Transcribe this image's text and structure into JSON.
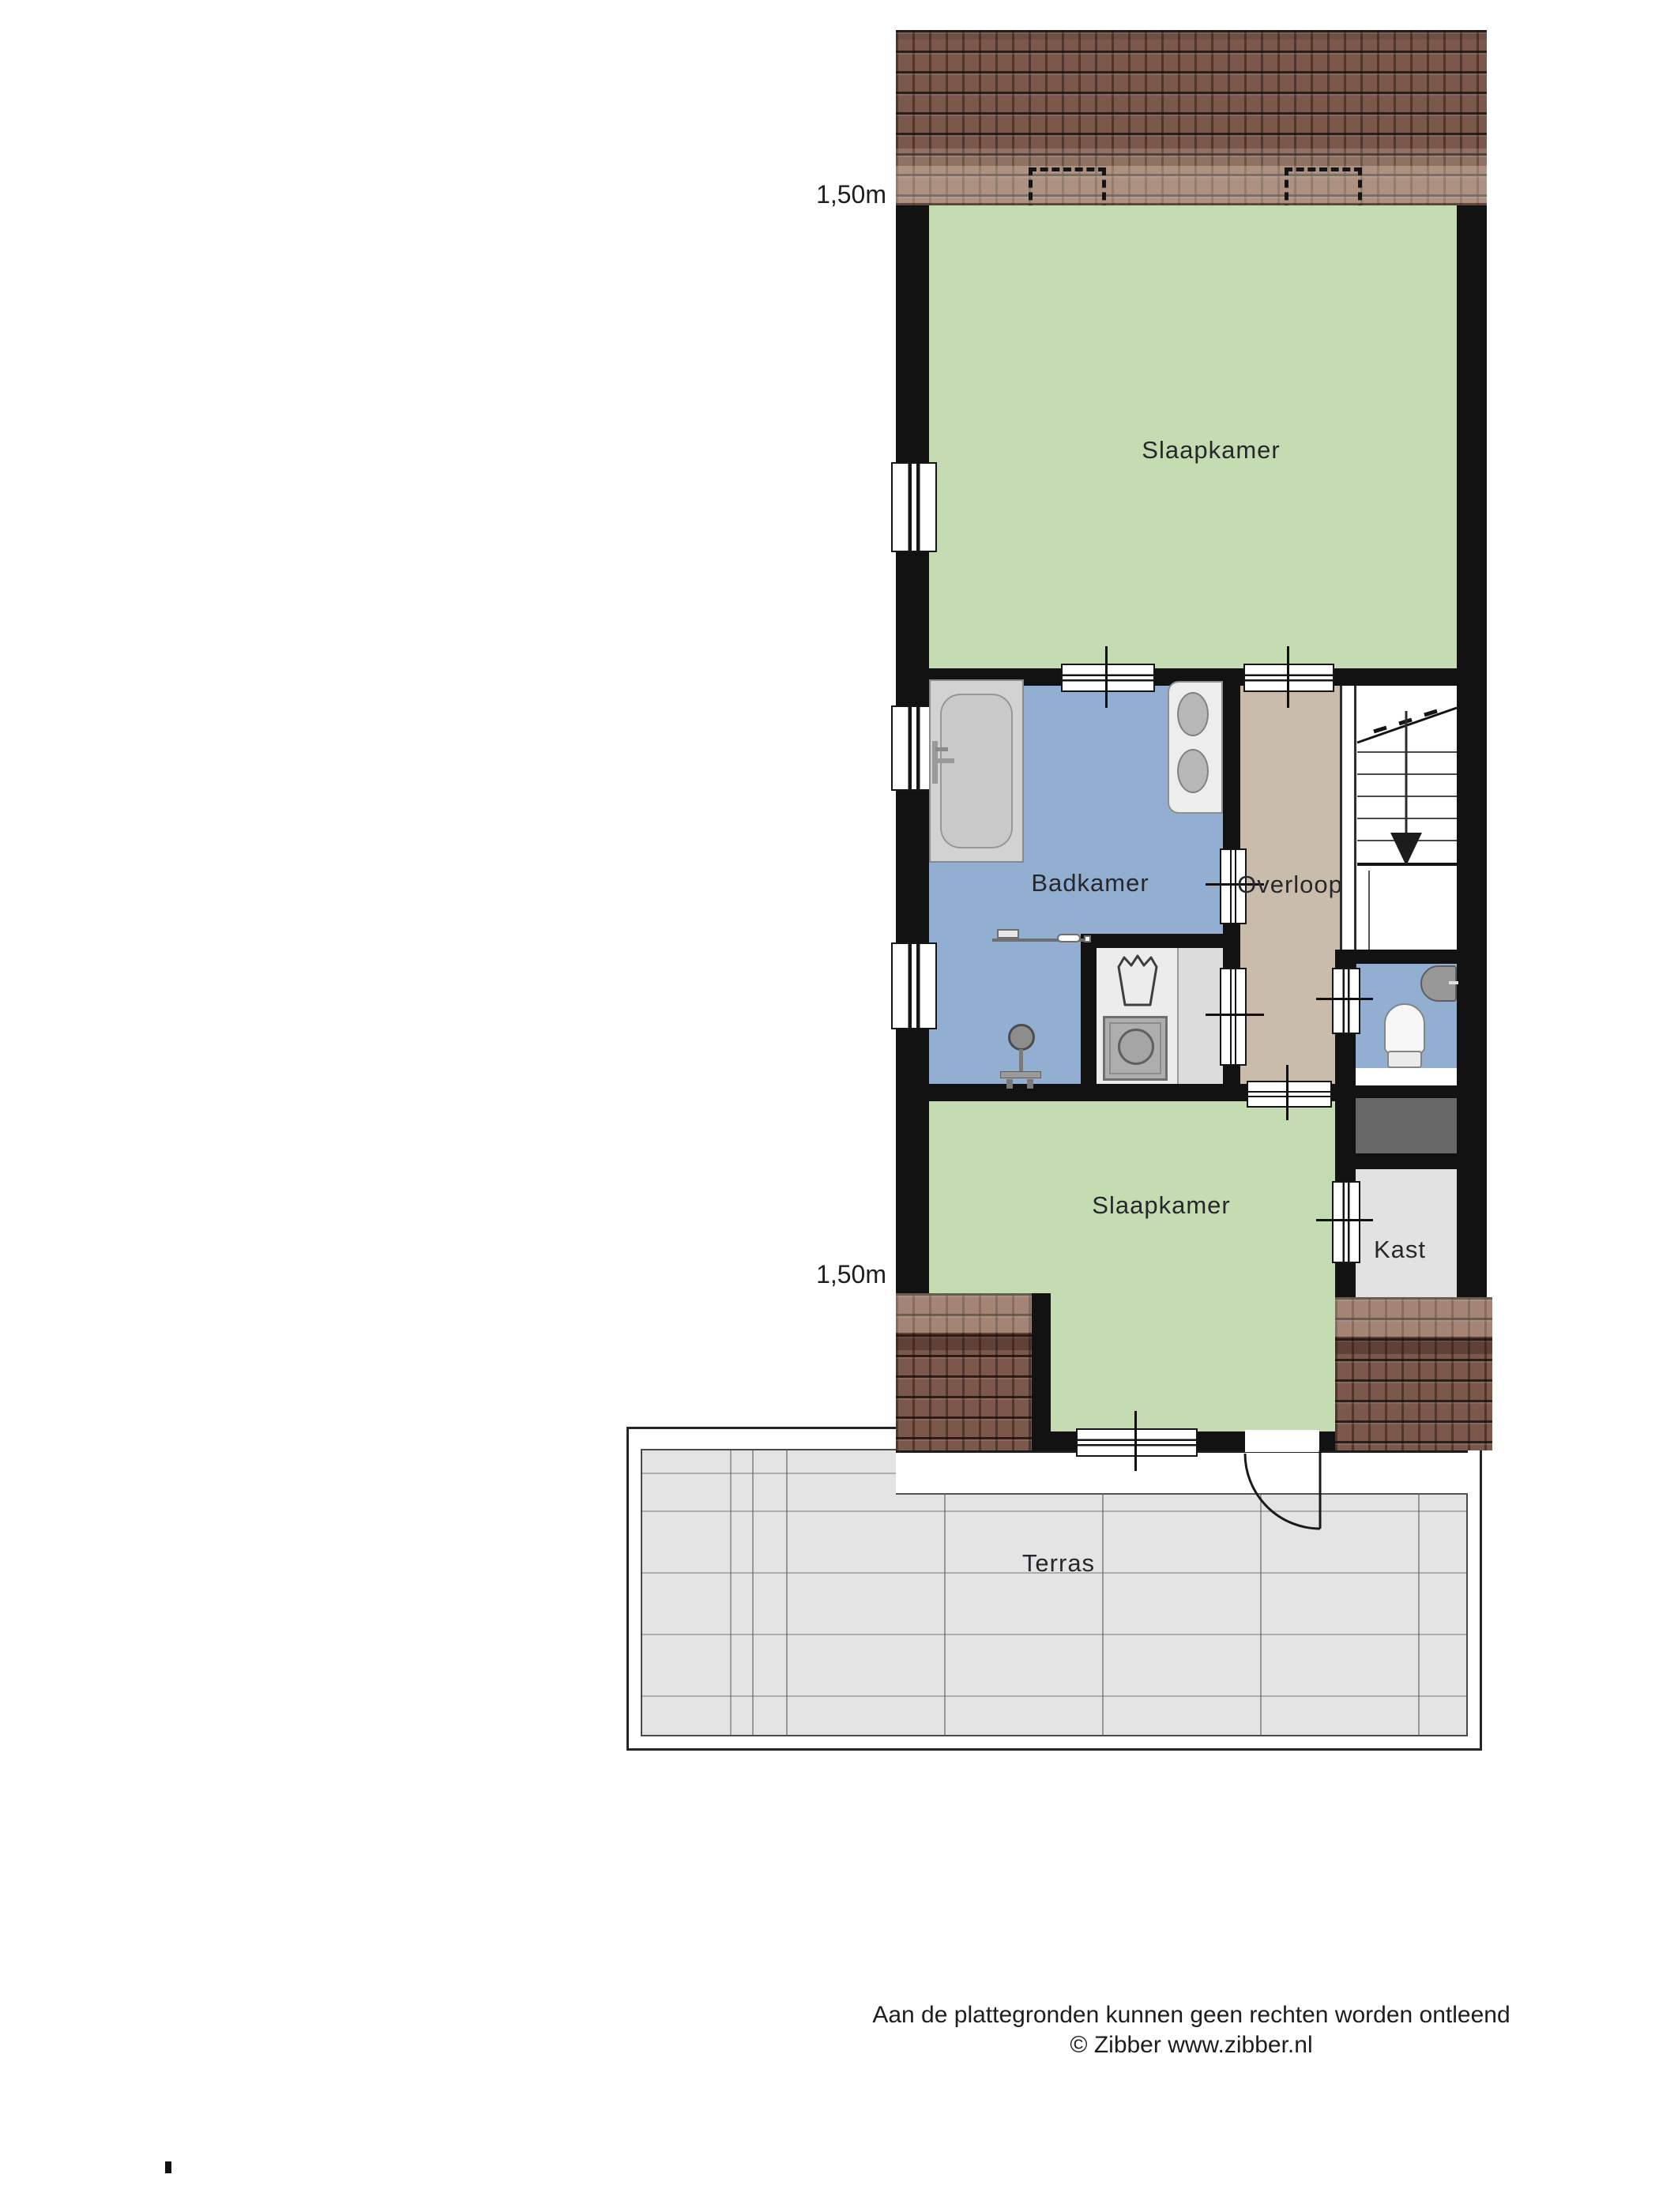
{
  "plan": {
    "type": "floorplan",
    "language": "nl",
    "rooms": [
      {
        "id": "slaapkamer-top",
        "label": "Slaapkamer",
        "color": "#c5dbb1"
      },
      {
        "id": "badkamer",
        "label": "Badkamer",
        "color": "#92aed0"
      },
      {
        "id": "overloop",
        "label": "Overloop",
        "color": "#c9bcaa"
      },
      {
        "id": "slaapkamer-bottom",
        "label": "Slaapkamer",
        "color": "#c5dbb1"
      },
      {
        "id": "kast",
        "label": "Kast",
        "color": "#e2e2e2"
      },
      {
        "id": "terras",
        "label": "Terras",
        "color": "#e4e4e4"
      }
    ],
    "dimension_labels": [
      {
        "text": "1,50m",
        "refers_to": "roof height line top"
      },
      {
        "text": "1,50m",
        "refers_to": "roof height line bottom"
      }
    ],
    "fixtures": [
      "bathtub",
      "double-washbasin",
      "towel-radiator",
      "shower",
      "laundry-basket",
      "washing-machine",
      "toilet",
      "hand-basin",
      "stairs-down",
      "terrace-door",
      "windows",
      "dormer-outlines",
      "roof-tiles",
      "storage-block"
    ],
    "stairs": {
      "direction": "down"
    },
    "colors": {
      "wall": "#121212",
      "roof": "#7c584c",
      "green_room": "#c5dbb1",
      "blue_room": "#92aed0",
      "tan_room": "#c9bcaa",
      "kast_gray": "#e2e2e2",
      "dark_block": "#686868",
      "terrace": "#e4e4e4"
    }
  },
  "footer": {
    "line1": "Aan de plattegronden kunnen geen rechten worden ontleend",
    "line2": "© Zibber www.zibber.nl"
  }
}
